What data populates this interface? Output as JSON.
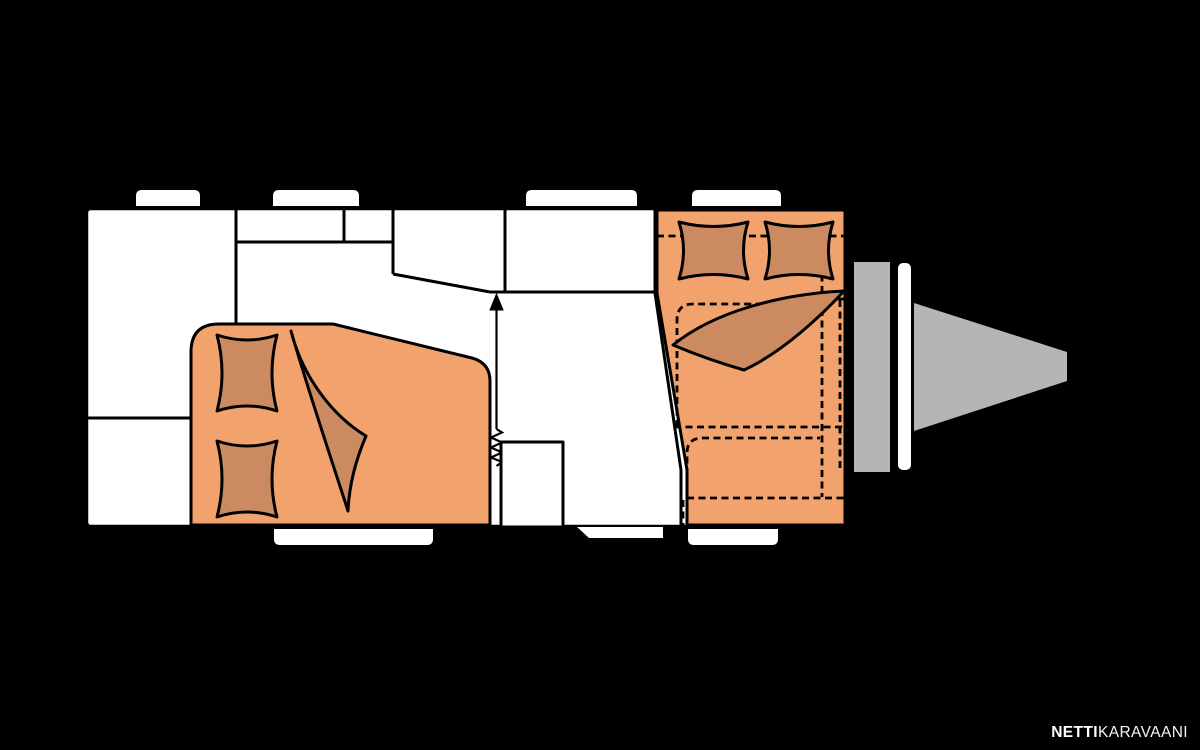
{
  "brand": {
    "bold": "NETTI",
    "light": "KARAVAANI"
  },
  "colors": {
    "background": "#000000",
    "body_fill": "#ffffff",
    "outline": "#000000",
    "accent": "#f2a36d",
    "accent_dark": "#cb8a5f",
    "hitch_gray": "#b5b5b5",
    "watermark": "#ffffff"
  },
  "floorplan": {
    "type": "caravan-floor-plan",
    "orientation": "tow-hitch-right",
    "windows_top": 4,
    "rail_tabs_bottom": 2,
    "entry_steps": 1,
    "upholstered_areas": 2,
    "pillows": 4,
    "blankets": 2,
    "areas": [
      {
        "id": "front-bed",
        "kind": "bed",
        "pillows": 2,
        "blanket": true
      },
      {
        "id": "kitchen-block",
        "kind": "cabinet-row"
      },
      {
        "id": "washroom",
        "kind": "compartment"
      },
      {
        "id": "wardrobe",
        "kind": "compartment"
      },
      {
        "id": "entrance",
        "kind": "door",
        "markers": [
          "arrow-up",
          "spring"
        ]
      },
      {
        "id": "rear-dinette",
        "kind": "seating-bed",
        "pillows": 2,
        "blanket": true,
        "cushion_outlines": "dashed"
      },
      {
        "id": "tow-hitch",
        "kind": "drawbar"
      }
    ]
  }
}
